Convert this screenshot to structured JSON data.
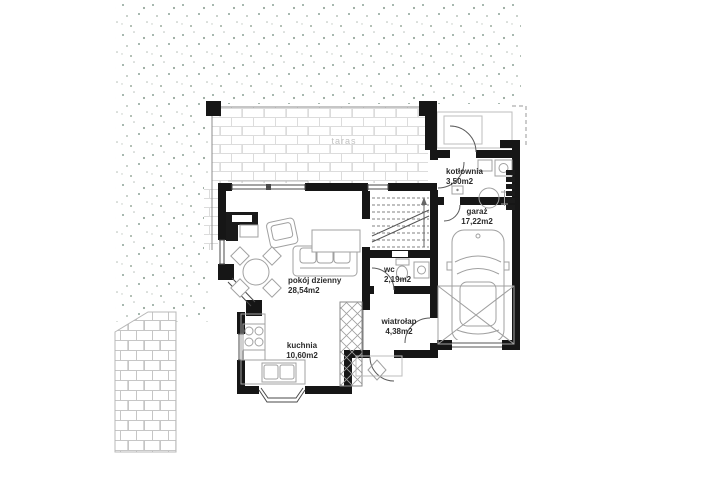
{
  "plan": {
    "labels": {
      "terrace": "taras"
    },
    "rooms": {
      "kotlownia": {
        "name": "kotłownia",
        "area": "3,50m2"
      },
      "garaz": {
        "name": "garaż",
        "area": "17,22m2"
      },
      "pokoj_dzienny": {
        "name": "pokój dzienny",
        "area": "28,54m2"
      },
      "wc": {
        "name": "wc",
        "area": "2,19m2"
      },
      "wiatrolap": {
        "name": "wiatrołap",
        "area": "4,38m2"
      },
      "kuchnia": {
        "name": "kuchnia",
        "area": "10,60m2"
      }
    },
    "colors": {
      "wall": "#161616",
      "window_line": "#4a4a4a",
      "furniture_line": "#a0a0a0",
      "brick_joint": "#dcdcdc",
      "grass_dot": "#93a69b",
      "room_label": "#2b2b2b",
      "terrace_label": "#c2c2c2"
    }
  }
}
